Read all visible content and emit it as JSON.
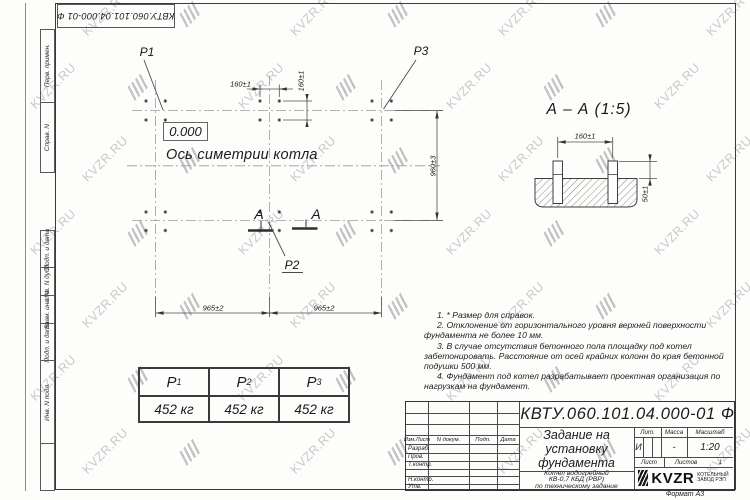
{
  "watermark": {
    "text": "KVZR.RU"
  },
  "stamp": {
    "doc_number": "КВТУ.060.101.04.000-01 Ф"
  },
  "margin": {
    "top": [
      "Перв. примен.",
      "Справ. N"
    ],
    "bottom": [
      "Подп. и дата",
      "Инв. N дубл.",
      "Взам. инв. N",
      "Подп. и дата",
      "Инв. N подл."
    ]
  },
  "plan": {
    "p1": "P1",
    "p2": "P2",
    "p3": "P3",
    "level": "0.000",
    "axis_caption": "Ось симетрии котла",
    "cut_letter": "А",
    "dim_160h": "160±1",
    "dim_160v": "160±1",
    "dim_960": "960±3",
    "dim_965_left": "965±2",
    "dim_965_right": "965±2"
  },
  "section": {
    "title": "А – А (1:5)",
    "dim_160": "160±1",
    "dim_50": "50±1"
  },
  "loads": {
    "headers": [
      {
        "b": "Р",
        "s": "1"
      },
      {
        "b": "Р",
        "s": "2"
      },
      {
        "b": "Р",
        "s": "3"
      }
    ],
    "values": [
      "452 кг",
      "452 кг",
      "452 кг"
    ]
  },
  "notes": {
    "items": [
      "1. * Размер для справок.",
      "2. Отклонение от горизонтального уровня верхней поверхности фундамента не более 10 мм.",
      "3. В случае отсутствия бетонного пола площадку под котел забетонировать. Расстояние от осей крайних колонн до края бетонной подушки 500 мм.",
      "4. Фундамент под котел разрабатывает проектная организация по нагрузкам на фундамент."
    ]
  },
  "title_block": {
    "doc_number": "КВТУ.060.101.04.000-01 Ф",
    "title_lines": [
      "Задание на",
      "установку",
      "фундамента"
    ],
    "product_lines": [
      "Котел водогрейный",
      "КВ-0,7 КБД (РВР)",
      "по техническому задание"
    ],
    "header_cols": [
      "Изм.Лист",
      "N докум.",
      "Подп.",
      "Дата"
    ],
    "sign_rows": [
      "Разраб.",
      "Пров.",
      "Т.контр.",
      "",
      "Н.контр.",
      "Утв."
    ],
    "lit_label": "Лит.",
    "mass_label": "Масса",
    "scale_label": "Масштаб",
    "lit_value": "И",
    "mass_value": "-",
    "scale_value": "1:20",
    "sheet_label": "Лист",
    "sheets_label": "Листов",
    "sheets_value": "1",
    "logo_text": "KVZR",
    "logo_caption": [
      "КОТЕЛЬНЫЙ",
      "ЗАВОД РЭП"
    ],
    "format_note": "Формат А3"
  }
}
